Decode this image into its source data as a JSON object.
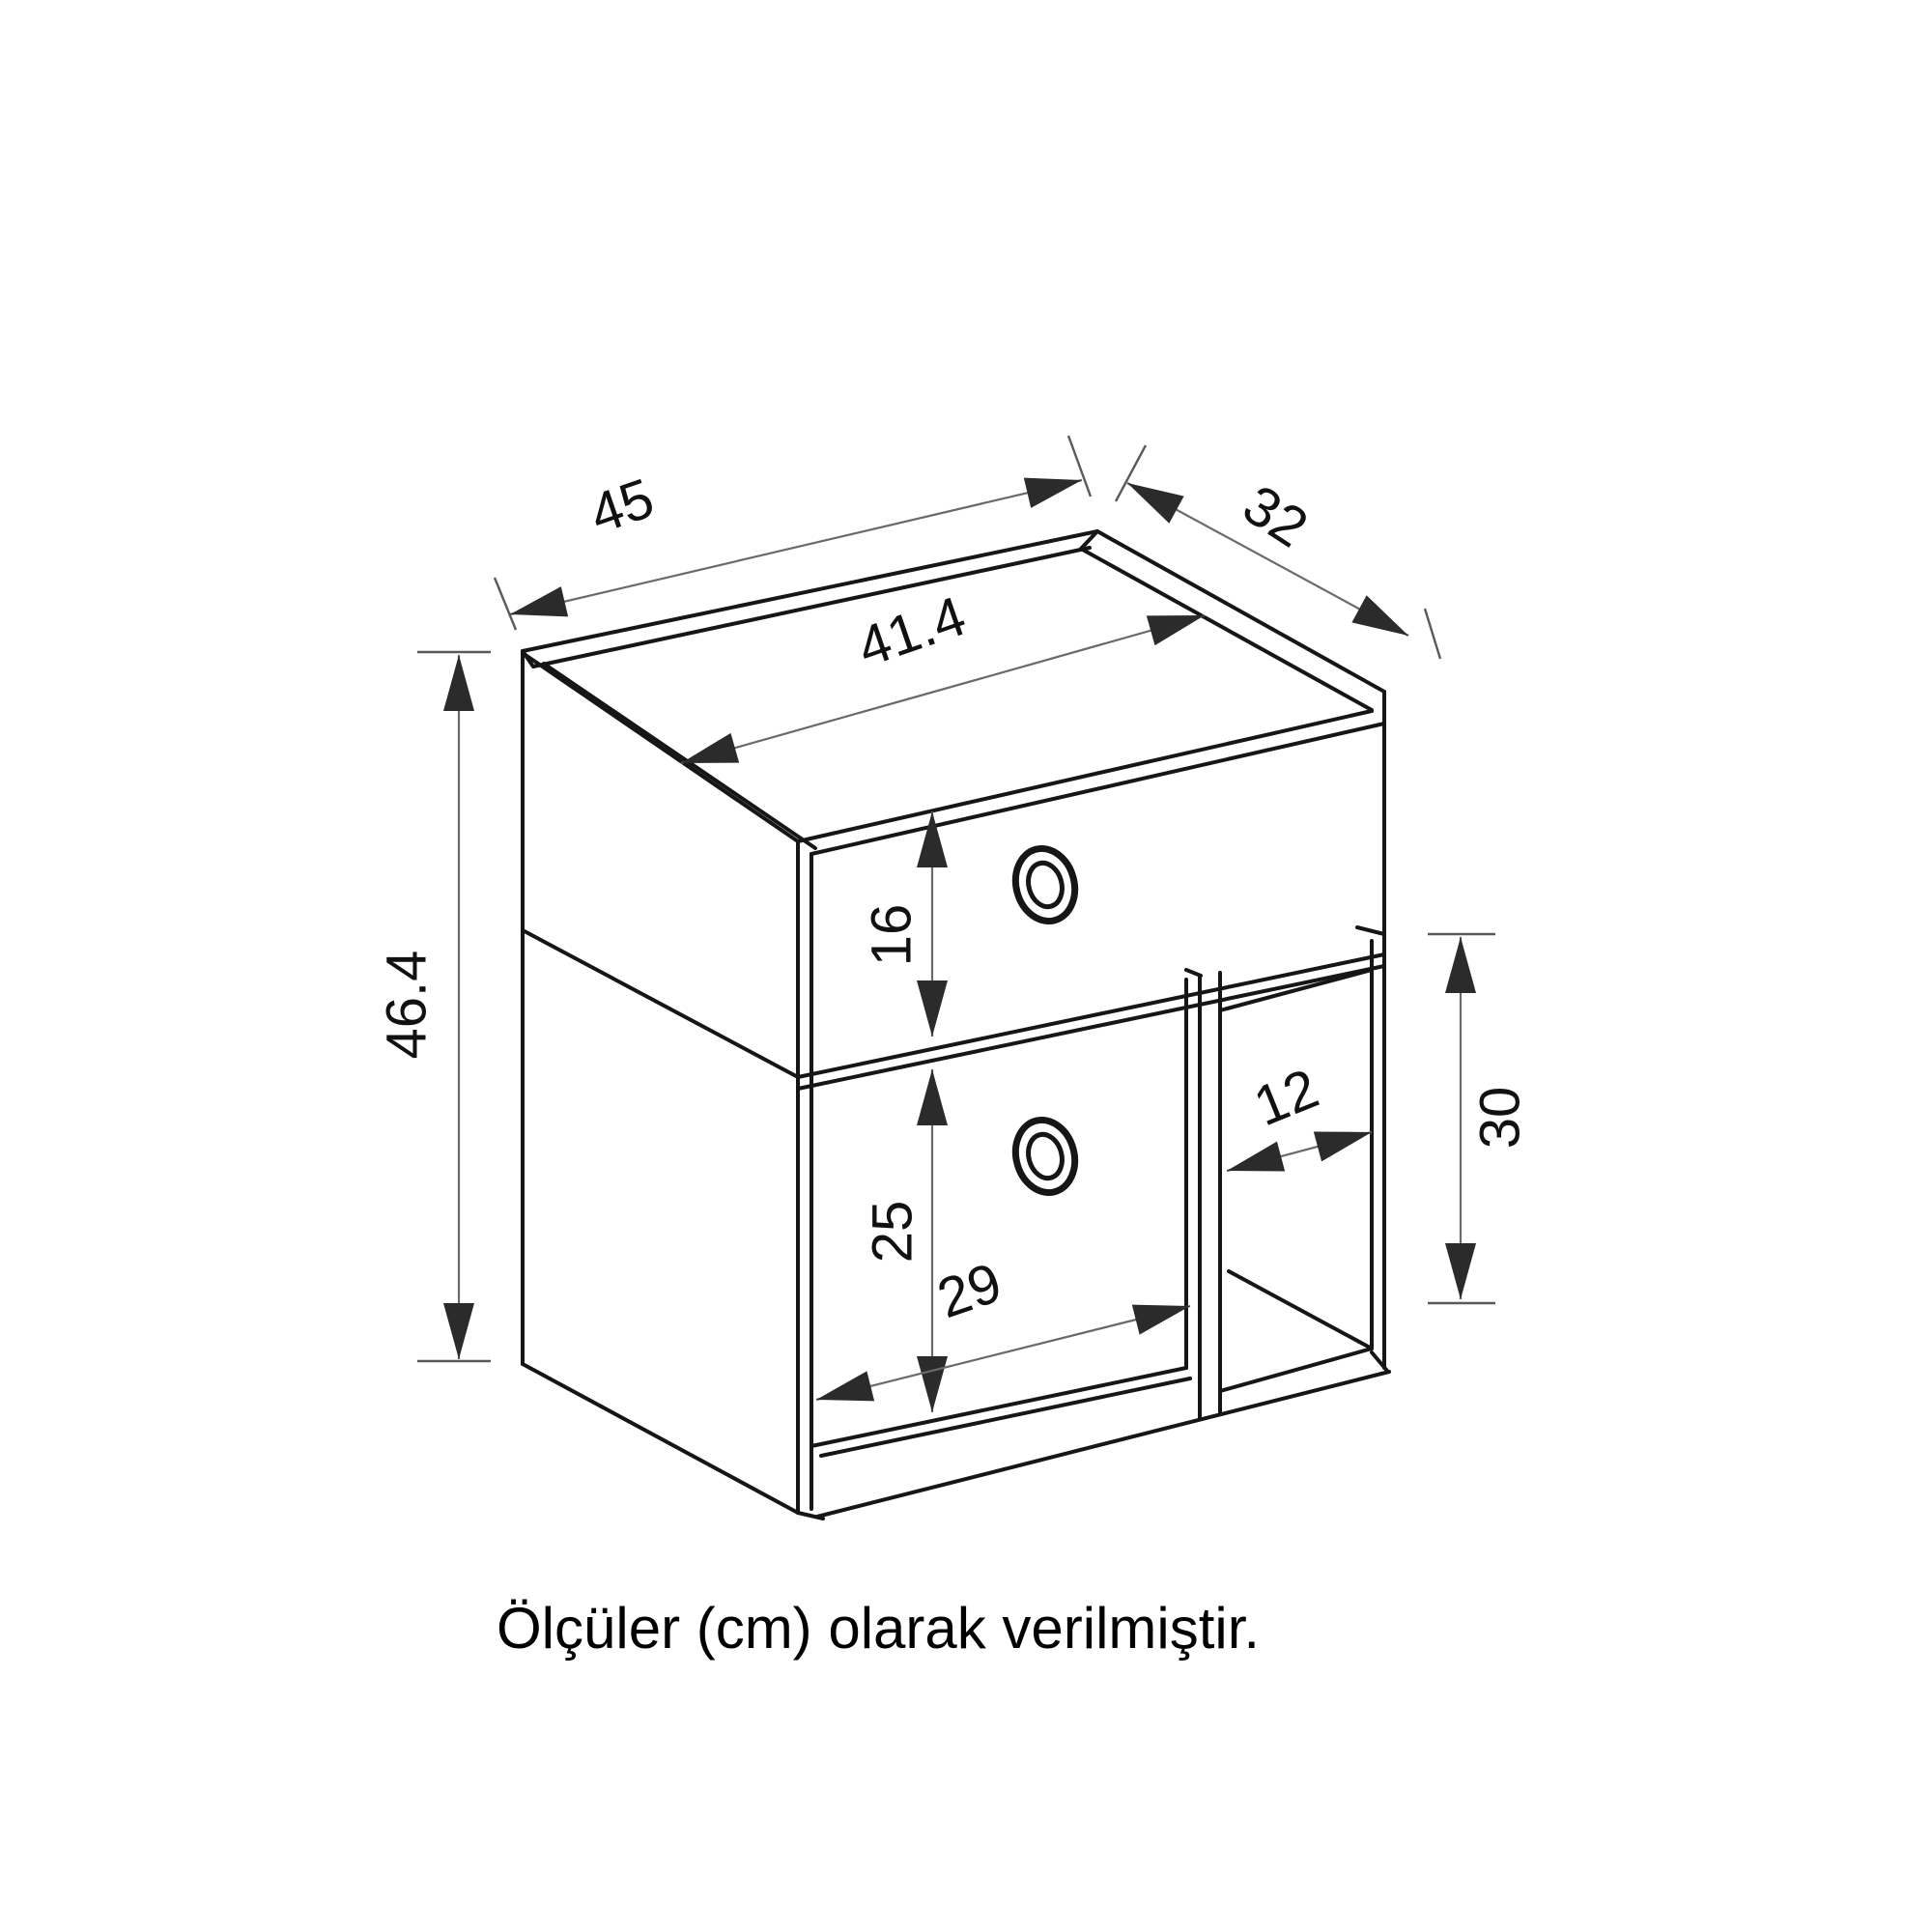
{
  "drawing": {
    "type": "furniture-dimension-diagram",
    "subject": "nightstand with top drawer, lower door and open side niche, isometric line drawing",
    "unit": "cm",
    "caption": {
      "text": "Ölçüler (cm) olarak verilmiştir."
    },
    "colors": {
      "background": "#ffffff",
      "outline": "#161616",
      "dimension_line": "#6a6a6a",
      "arrowhead": "#2b2b2b",
      "text": "#111111"
    },
    "dimensions": {
      "top_width": {
        "value": "45",
        "meaning": "overall width of top"
      },
      "top_depth": {
        "value": "32",
        "meaning": "overall depth of top"
      },
      "inner_width": {
        "value": "41.4",
        "meaning": "inner width of top between side panels"
      },
      "total_height": {
        "value": "46.4",
        "meaning": "overall height"
      },
      "drawer_height": {
        "value": "16",
        "meaning": "drawer front height"
      },
      "door_height": {
        "value": "25",
        "meaning": "door height"
      },
      "door_width": {
        "value": "29",
        "meaning": "door width"
      },
      "niche_width": {
        "value": "12",
        "meaning": "open compartment width"
      },
      "niche_height": {
        "value": "30",
        "meaning": "open compartment height"
      }
    }
  }
}
